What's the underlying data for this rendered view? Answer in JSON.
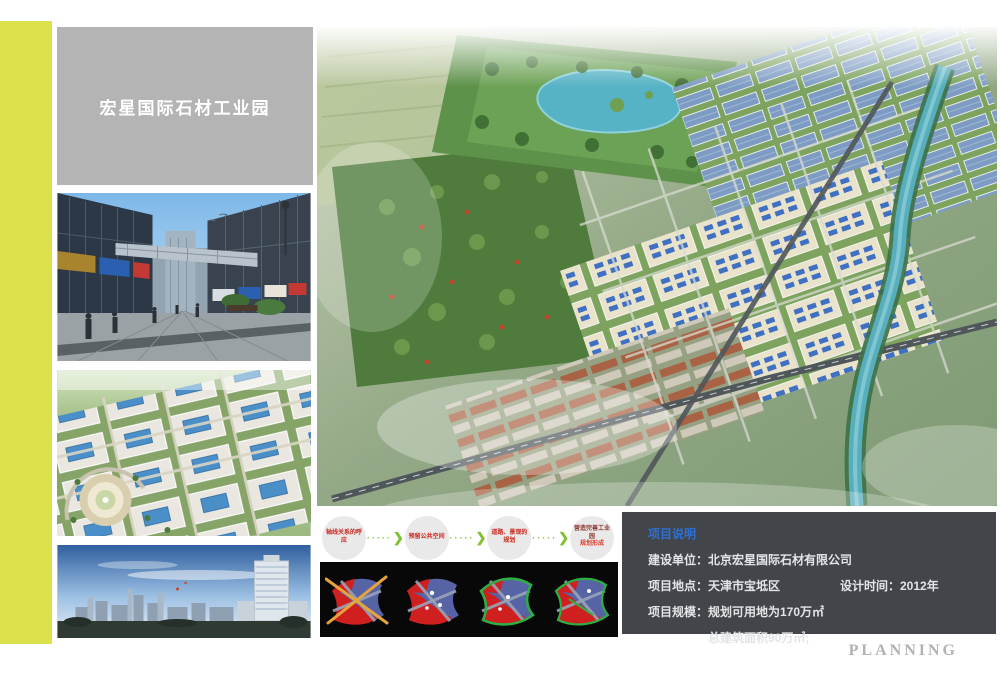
{
  "board": {
    "title": "宏星国际石材工业园",
    "planning_label": "PLANNING"
  },
  "flow": {
    "steps": [
      {
        "line1": "轴线关系的呼应",
        "line2": ""
      },
      {
        "line1": "预留公共空间",
        "line2": ""
      },
      {
        "line1": "道路、景观的规划",
        "line2": ""
      },
      {
        "line1": "营造完善工业园",
        "line2": "规划形成"
      }
    ],
    "arrow_dots": "·····",
    "arrow_head": "❯"
  },
  "project_info": {
    "title": "项目说明",
    "rows": [
      "建设单位：北京宏星国际石材有限公司",
      "项目地点：天津市宝坻区",
      "设计时间：2012年",
      "项目规模：规划可用地为170万㎡",
      "总建筑面积90万㎡;"
    ]
  },
  "colors": {
    "accent_strip": "#dce24b",
    "title_box_gray": "#b4b4b4",
    "info_box_bg": "#42464b",
    "info_title_blue": "#2f6fd0",
    "flow_arrow_green": "#7fc131",
    "flow_text_red": "#c9281e",
    "planning_gray": "#b2b2b2"
  }
}
